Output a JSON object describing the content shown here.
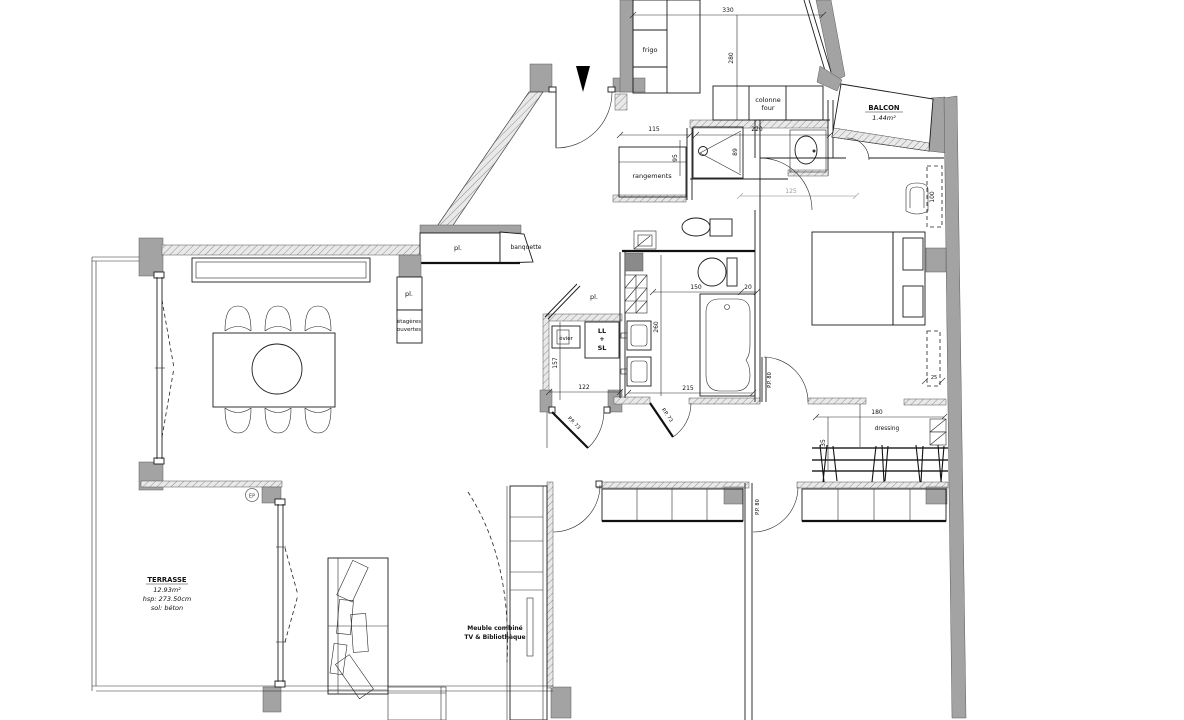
{
  "plan": {
    "kitchen": {
      "frigo": "frigo",
      "colonne": "colonne",
      "four": "four"
    },
    "balcony": {
      "title": "BALCON",
      "area": "1.44m²"
    },
    "entry": {
      "rangements": "rangements",
      "banquette": "banquette",
      "closet_top": "pl.",
      "closet_col": "pl.",
      "shelves_line1": "étagères",
      "shelves_line2": "ouvertes"
    },
    "laundry": {
      "closet": "pl.",
      "sink": "évier",
      "washer": "LL",
      "plus": "+",
      "dryer": "SL"
    },
    "bedroom": {
      "dressing": "dressing"
    },
    "living": {
      "tv_line1": "Meuble combiné",
      "tv_line2": "TV & Bibliothèque"
    },
    "terrace": {
      "title": "TERRASSE",
      "area": "12.93m²",
      "ceiling": "hsp: 273.50cm",
      "floor": "sol: béton",
      "drain": "EP"
    },
    "doors": {
      "pp73_a": "P.P. 73",
      "pp73_b": "P.P. 73",
      "pp80_a": "P.P. 80",
      "pp80_b": "P.P. 80"
    },
    "dims": {
      "d330": "330",
      "d280": "280",
      "d115": "115",
      "d95": "95",
      "d220": "220",
      "d89": "89",
      "d125": "125",
      "d100": "100",
      "d150": "150",
      "d20": "20",
      "d260": "260",
      "d215": "215",
      "d157": "157",
      "d122": "122",
      "d180": "180",
      "d35": "35",
      "d25": "25"
    }
  },
  "colors": {
    "wall": "#a3a3a3",
    "line": "#1c1c1c",
    "background": "#ffffff"
  }
}
